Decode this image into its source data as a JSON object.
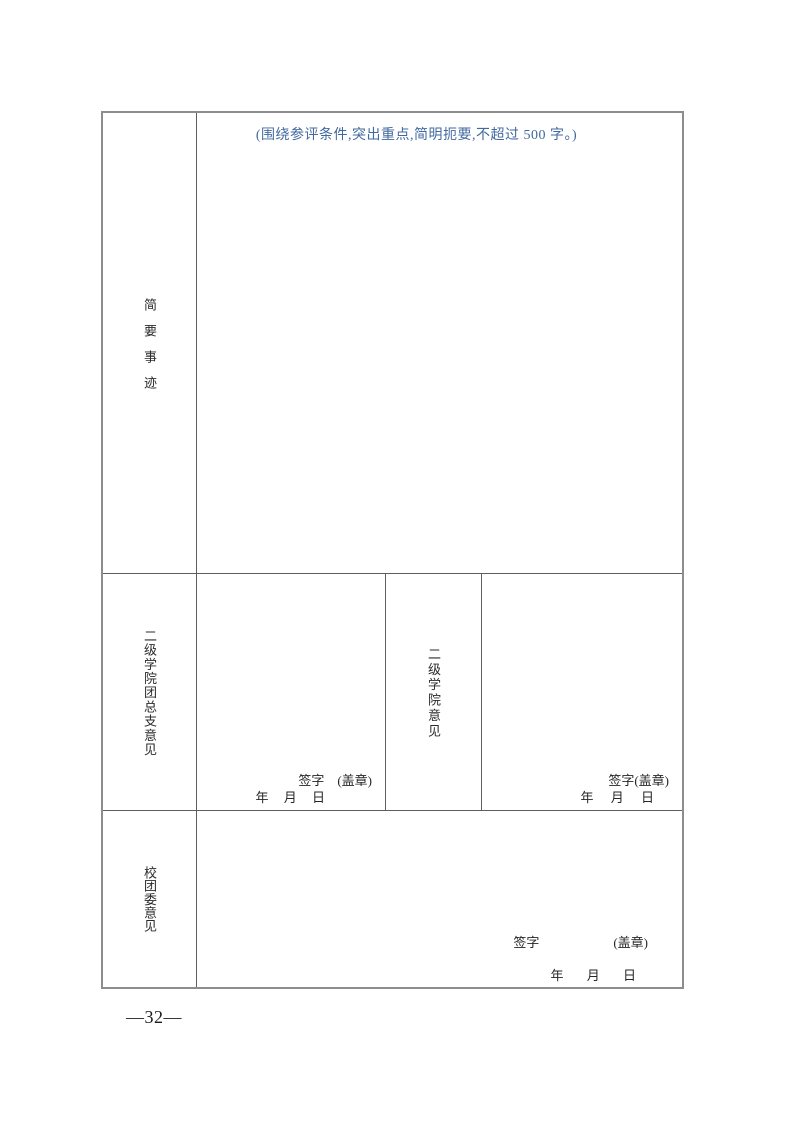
{
  "document": {
    "page_number": "—32—"
  },
  "form": {
    "brief_deeds": {
      "label": "简要事迹",
      "hint": "(围绕参评条件,突出重点,简明扼要,不超过 500 字。)"
    },
    "league_branch_opinion": {
      "label": "二级学院团总支意见",
      "sign_label": "签字",
      "seal_label": "(盖章)",
      "date_line": "年 月 日"
    },
    "college_opinion": {
      "label": "二级学院意见",
      "sign_label": "签字",
      "seal_label": "(盖章)",
      "date_line": "年 月 日"
    },
    "school_committee_opinion": {
      "label": "校团委意见",
      "sign_label": "签字",
      "seal_label": "(盖章)",
      "date_line": "年 月 日"
    }
  },
  "colors": {
    "hint_blue": "#41699f",
    "border_gray": "#5e5e5e"
  }
}
